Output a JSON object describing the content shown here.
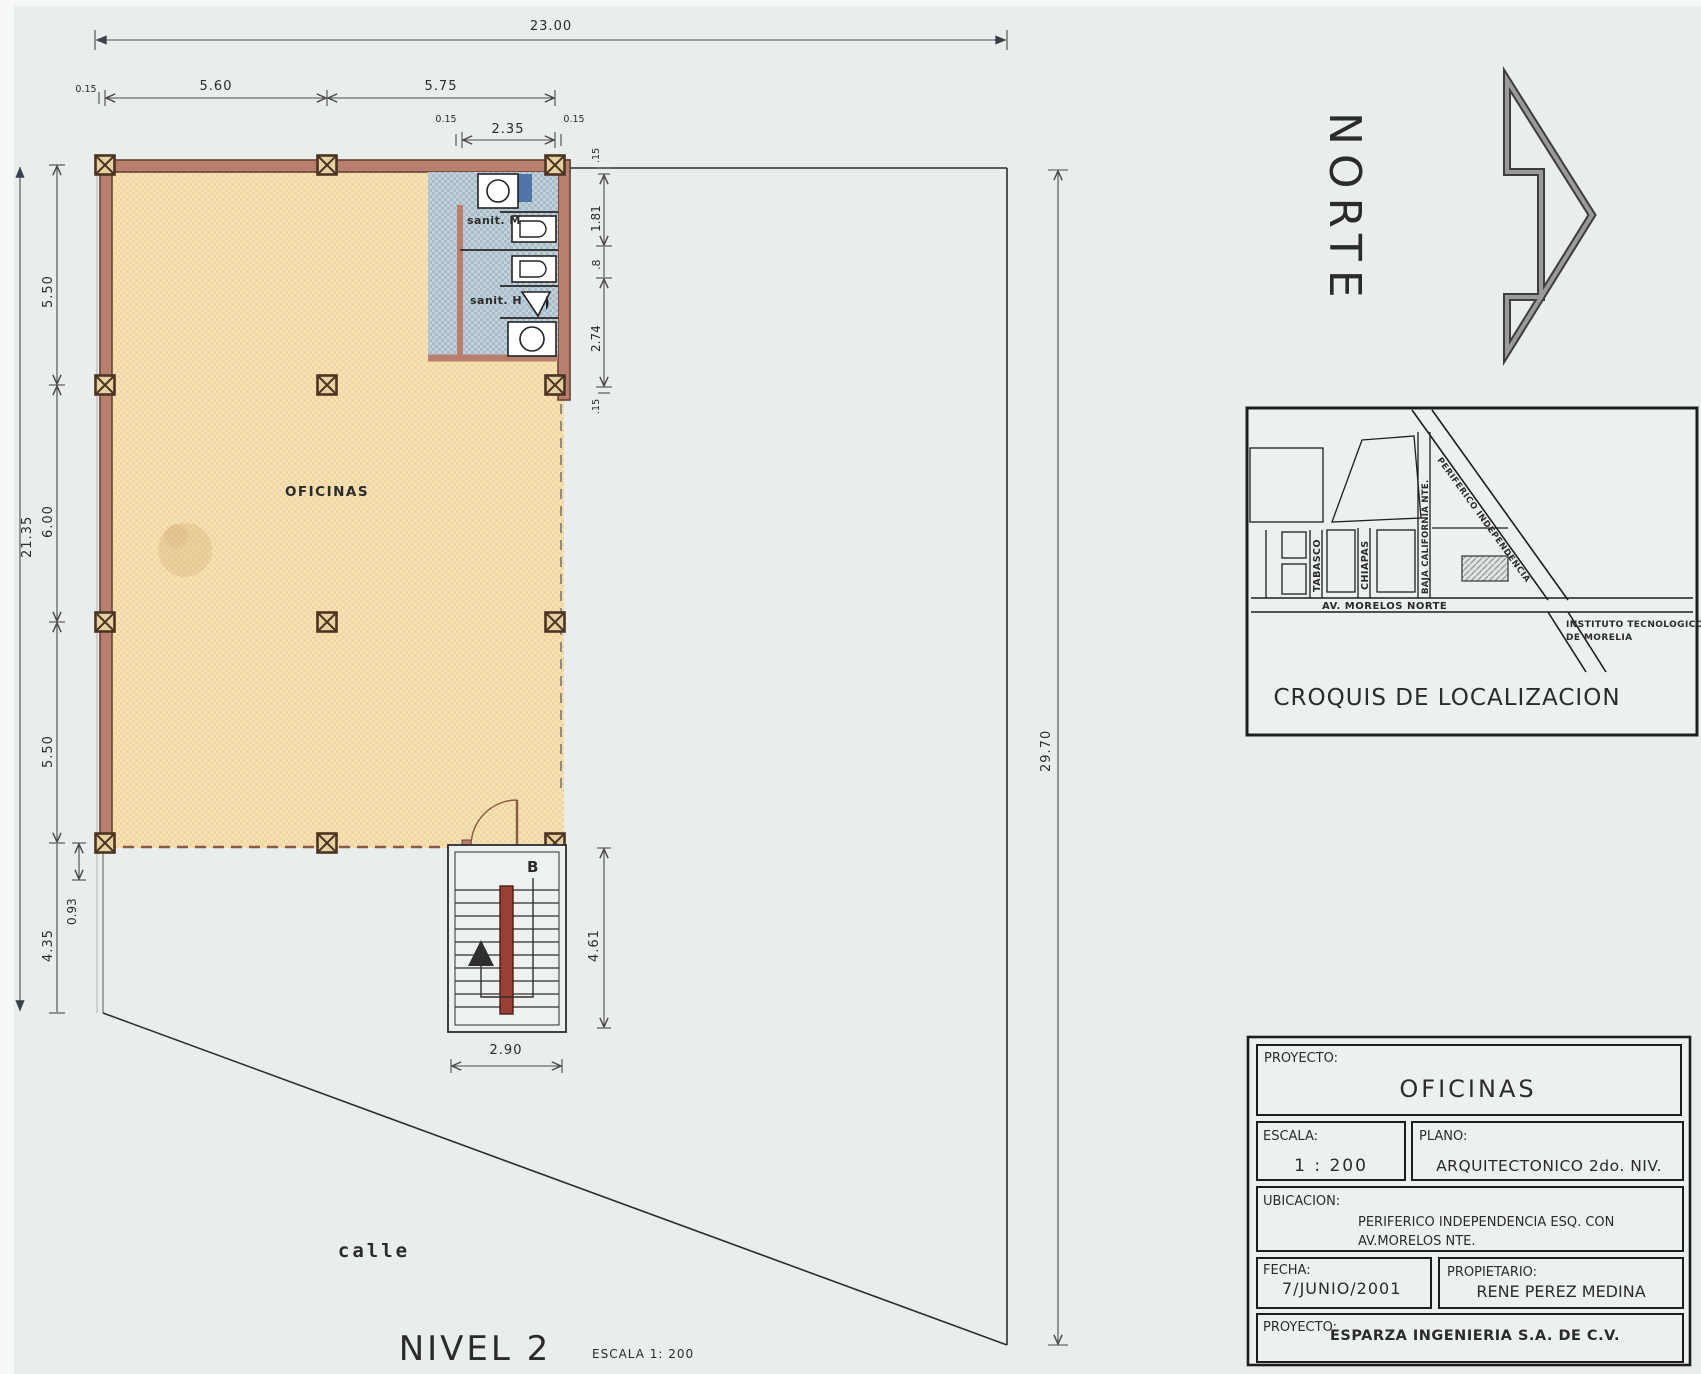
{
  "colors": {
    "paper": "#e9edec",
    "floor": "#f6e2b4",
    "floor_dot": "#e8cf9a",
    "wall": "#b97f6e",
    "wall_dark": "#6b4236",
    "sanit_floor": "#b3c5cf",
    "stair_rail": "#993f33",
    "fixture_blue": "#4f74a8",
    "ink": "#2b2b2b"
  },
  "plan": {
    "room_label": "OFICINAS",
    "sanit_m_label": "sanit. M",
    "sanit_h_label": "sanit. H",
    "stair_section_label": "B",
    "street_label": "calle",
    "level_title": "NIVEL 2",
    "scale_note": "ESCALA 1: 200",
    "north_label": "NORTE",
    "dims": {
      "site_width": "23.00",
      "site_depth": "29.70",
      "top_lead": "0.15",
      "top_row": [
        "5.60",
        "5.75"
      ],
      "sanit_row": [
        "0.15",
        "2.35",
        "0.15"
      ],
      "right_chain": [
        ".15",
        "1.81",
        ".8",
        "2.74",
        ".15"
      ],
      "left_total": "21.35",
      "left_chain": [
        "5.50",
        "6.00",
        "5.50"
      ],
      "left_small": "0.93",
      "left_bottom": "4.35",
      "stair_width": "2.90",
      "stair_depth": "4.61"
    }
  },
  "croquis": {
    "title": "CROQUIS DE LOCALIZACION",
    "streets": {
      "tabasco": "TABASCO",
      "chiapas": "CHIAPAS",
      "baja_california": "BAJA CALIFORNIA NTE.",
      "periferico": "PERIFERICO INDEPENDENCIA",
      "morelos": "AV. MORELOS NORTE"
    },
    "landmark_line1": "INSTITUTO TECNOLOGICO",
    "landmark_line2": "DE MORELIA"
  },
  "titleblock": {
    "proyecto_label": "PROYECTO:",
    "proyecto_value": "OFICINAS",
    "escala_label": "ESCALA:",
    "escala_value": "1 : 200",
    "plano_label": "PLANO:",
    "plano_value": "ARQUITECTONICO  2do. NIV.",
    "ubicacion_label": "UBICACION:",
    "ubicacion_line1": "PERIFERICO INDEPENDENCIA ESQ. CON",
    "ubicacion_line2": "AV.MORELOS NTE.",
    "fecha_label": "FECHA:",
    "fecha_value": "7/JUNIO/2001",
    "propietario_label": "PROPIETARIO:",
    "propietario_value": "RENE PEREZ MEDINA",
    "empresa_label": "PROYECTO:",
    "empresa_value": "ESPARZA INGENIERIA S.A. DE C.V."
  }
}
